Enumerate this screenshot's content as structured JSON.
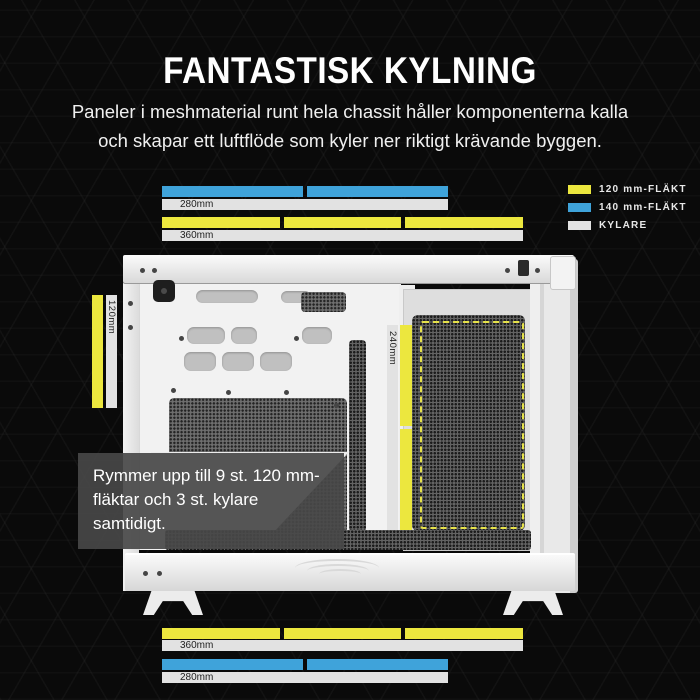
{
  "title": "FANTASTISK KYLNING",
  "subtitle": {
    "line1": "Paneler i meshmaterial runt hela chassit håller komponenterna kalla",
    "line2": "och skapar ett luftflöde som kyler ner riktigt krävande byggen."
  },
  "colors": {
    "fan_120mm": "#ece73e",
    "fan_140mm": "#3fa3da",
    "kylare_bar": "#e2e2e2",
    "accent_dashed": "#e6e24a",
    "page_background": "#0a0a0a"
  },
  "legend": {
    "items": [
      {
        "id": "fan-120mm",
        "label": "120 mm-FLÄKT"
      },
      {
        "id": "fan-140mm",
        "label": "140 mm-FLÄKT"
      },
      {
        "id": "kylare",
        "label": "KYLARE"
      }
    ]
  },
  "measurements": {
    "top": {
      "fan140_segments": 2,
      "radiator_280": "280mm",
      "fan120_segments": 3,
      "radiator_360": "360mm"
    },
    "left_side": {
      "fan120_label": "120mm"
    },
    "internal": {
      "label": "240mm",
      "fan120_segments": 2
    },
    "bottom": {
      "fan120_segments": 3,
      "radiator_360": "360mm",
      "fan140_segments": 2,
      "radiator_280": "280mm"
    }
  },
  "callout": {
    "text": "Rymmer upp till 9 st. 120 mm-fläktar och 3 st. kylare samtidigt."
  }
}
